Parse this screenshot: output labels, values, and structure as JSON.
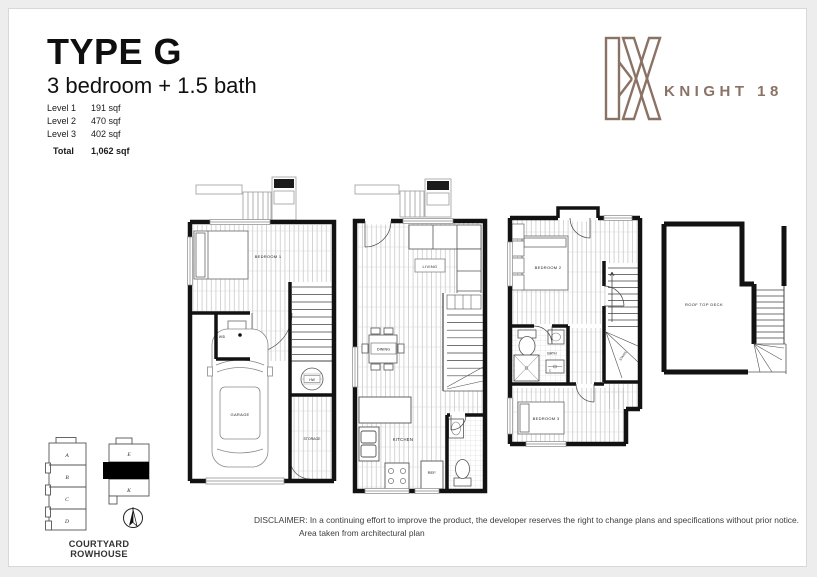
{
  "header": {
    "title": "TYPE G",
    "subtitle": "3 bedroom + 1.5 bath",
    "areas": [
      {
        "label": "Level 1",
        "value": "191 sqf"
      },
      {
        "label": "Level 2",
        "value": "470 sqf"
      },
      {
        "label": "Level 3",
        "value": "402 sqf"
      }
    ],
    "total": {
      "label": "Total",
      "value": "1,062 sqf"
    }
  },
  "brand": {
    "name": "KNIGHT 18",
    "color": "#8a7265"
  },
  "plans": {
    "level1": {
      "bedroom1": "BEDROOM 1",
      "wd": "W/D",
      "hw": "HW",
      "garage": "GARAGE",
      "storage": "STORAGE"
    },
    "level2": {
      "living": "LIVING",
      "dining": "DINING",
      "kitchen": "KITCHEN",
      "ref": "REF."
    },
    "level3": {
      "bedroom2": "BEDROOM 2",
      "bath": "BATH",
      "closet": "C",
      "bedroom3": "BEDROOM 3",
      "stairs": "STAIRS"
    },
    "roof": {
      "deck": "ROOF TOP DECK"
    }
  },
  "keyplan": {
    "caption": "COURTYARD ROWHOUSE",
    "left_units": [
      "A",
      "B",
      "C",
      "D"
    ],
    "right_units": [
      "E",
      "K"
    ]
  },
  "disclaimer": {
    "line1": "DISCLAIMER: In a continuing effort to improve the product, the developer reserves the right to change plans and specifications without prior notice.",
    "line2": "Area taken from architectural plan"
  }
}
